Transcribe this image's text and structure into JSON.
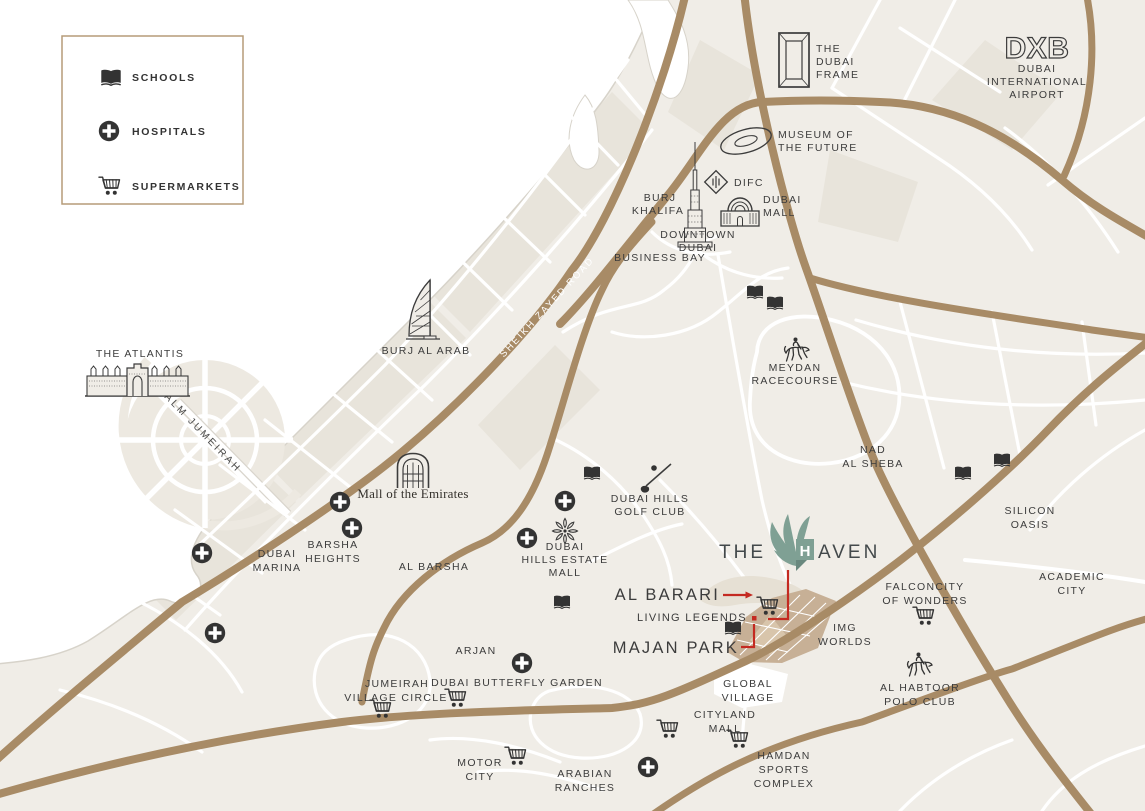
{
  "colors": {
    "land": "#F0EDE7",
    "water": "#FFFFFF",
    "block": "#E8E4DB",
    "coastline": "#D7D3CA",
    "road_major": "#A88B66",
    "road_minor": "#FFFFFF",
    "ink": "#3C3C3C",
    "icon_dark": "#333333",
    "accent_red": "#C42A21",
    "brand_teal": "#7FA094",
    "brand_teal_dark": "#69887E",
    "legend_border": "#B59B78",
    "site_fill": "#C7B096",
    "site_light": "#D8C5AB",
    "barari_fill": "#E6E0D4"
  },
  "legend": {
    "items": [
      {
        "icon": "school-book-icon",
        "label": "SCHOOLS"
      },
      {
        "icon": "hospital-cross-icon",
        "label": "HOSPITALS"
      },
      {
        "icon": "supermarket-cart-icon",
        "label": "SUPERMARKETS"
      }
    ]
  },
  "brand": {
    "pre": "THE",
    "mark_letter": "H",
    "post": "AVEN"
  },
  "roads": {
    "sheikh_zayed": "SHEIKH ZAYED ROAD",
    "palm_jumeirah": "PALM JUMEIRAH"
  },
  "labels": {
    "dxb": "DXB",
    "airport": {
      "lines": [
        "DUBAI",
        "INTERNATIONAL",
        "AIRPORT"
      ]
    },
    "dubai_frame": {
      "lines": [
        "THE",
        "DUBAI",
        "FRAME"
      ]
    },
    "museum_of_future": {
      "lines": [
        "MUSEUM OF",
        "THE FUTURE"
      ]
    },
    "difc": "DIFC",
    "burj_khalifa": {
      "lines": [
        "BURJ",
        "KHALIFA"
      ]
    },
    "dubai_mall": {
      "lines": [
        "DUBAI",
        "MALL"
      ]
    },
    "downtown": {
      "lines": [
        "DOWNTOWN",
        "DUBAI"
      ]
    },
    "business_bay": "BUSINESS BAY",
    "burj_al_arab": "BURJ AL ARAB",
    "the_atlantis": "THE ATLANTIS",
    "meydan": {
      "lines": [
        "MEYDAN",
        "RACECOURSE"
      ]
    },
    "nad_al_sheba": {
      "lines": [
        "NAD",
        "AL SHEBA"
      ]
    },
    "silicon_oasis": {
      "lines": [
        "SILICON",
        "OASIS"
      ]
    },
    "academic_city": {
      "lines": [
        "ACADEMIC",
        "CITY"
      ]
    },
    "mall_of_emirates": "Mall of the Emirates",
    "dubai_marina": {
      "lines": [
        "DUBAI",
        "MARINA"
      ]
    },
    "barsha_heights": {
      "lines": [
        "BARSHA",
        "HEIGHTS"
      ]
    },
    "al_barsha": "AL BARSHA",
    "dubai_hills_golf": {
      "lines": [
        "DUBAI HILLS",
        "GOLF CLUB"
      ]
    },
    "dubai_hills_mall": {
      "lines": [
        "DUBAI",
        "HILLS ESTATE",
        "MALL"
      ]
    },
    "al_barari": "AL BARARI",
    "living_legends": "LIVING LEGENDS",
    "majan_park": "MAJAN PARK",
    "img_worlds": {
      "lines": [
        "IMG",
        "WORLDS"
      ]
    },
    "falconcity": {
      "lines": [
        "FALCONCITY",
        "OF WONDERS"
      ]
    },
    "al_habtoor": {
      "lines": [
        "AL HABTOOR",
        "POLO CLUB"
      ]
    },
    "arjan": "ARJAN",
    "jvc": {
      "lines": [
        "JUMEIRAH",
        "VILLAGE CIRCLE"
      ]
    },
    "butterfly_garden": "DUBAI BUTTERFLY GARDEN",
    "global_village": {
      "lines": [
        "GLOBAL",
        "VILLAGE"
      ]
    },
    "cityland_mall": {
      "lines": [
        "CITYLAND",
        "MALL"
      ]
    },
    "hamdan": {
      "lines": [
        "HAMDAN",
        "SPORTS",
        "COMPLEX"
      ]
    },
    "motor_city": {
      "lines": [
        "MOTOR",
        "CITY"
      ]
    },
    "arabian_ranches": {
      "lines": [
        "ARABIAN",
        "RANCHES"
      ]
    }
  }
}
